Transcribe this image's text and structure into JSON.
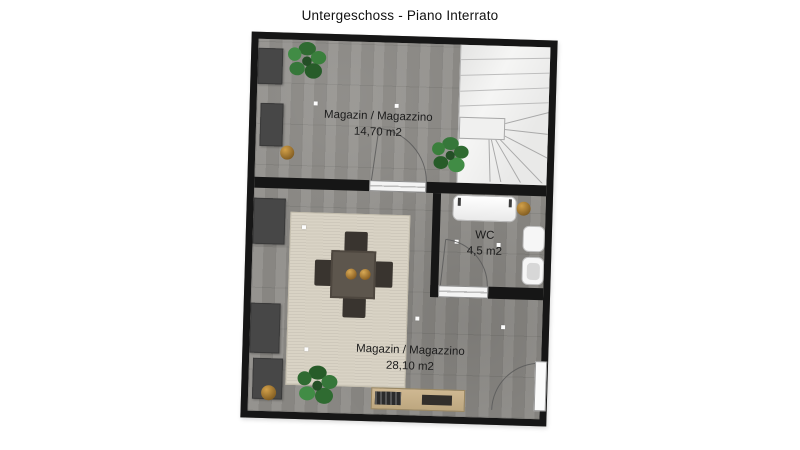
{
  "title": "Untergeschoss - Piano Interrato",
  "floorplan": {
    "rooms": [
      {
        "id": "storage-upper",
        "label": "Magazin / Magazzino",
        "area": "14,70 m2"
      },
      {
        "id": "wc",
        "label": "WC",
        "area": "4,5 m2"
      },
      {
        "id": "storage-lower",
        "label": "Magazin / Magazzino",
        "area": "28,10 m2"
      }
    ],
    "colors": {
      "wall": "#161616",
      "floor": "#8f8d89",
      "rug": "#d9d3c5",
      "stairs": "#f5f5f4",
      "plant_green": "#2f6b31",
      "wood": "#c9b28c",
      "fixture_white": "#f6f6f6",
      "pot_gold": "#d2a049",
      "title_text": "#111111",
      "label_text": "#1c1c1c"
    }
  }
}
